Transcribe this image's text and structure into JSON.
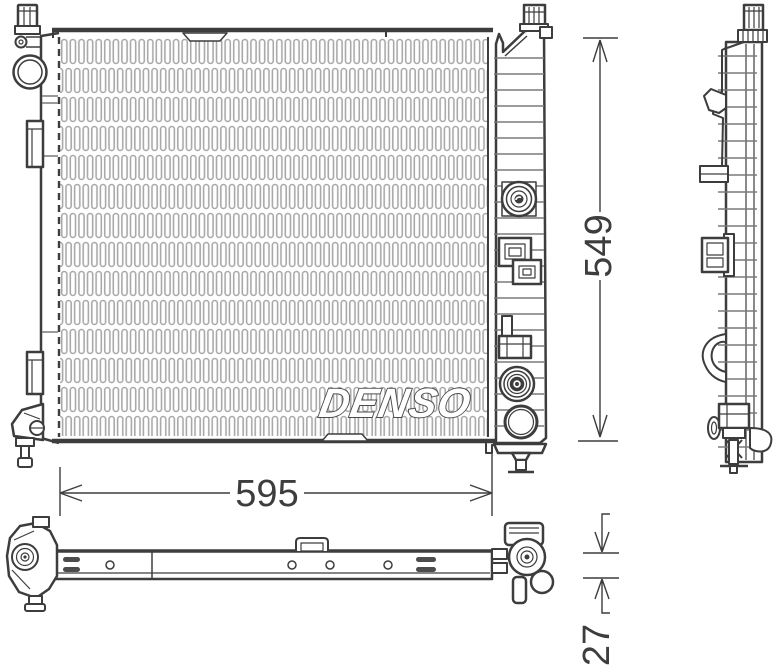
{
  "drawing": {
    "watermark": "DENSO",
    "dimension_width": "595",
    "dimension_height": "549",
    "dimension_thickness": "27",
    "colors": {
      "line": "#3d3d3d",
      "rib": "#7a7a7a",
      "fin": "#a9a9a9",
      "background": "#ffffff"
    }
  }
}
